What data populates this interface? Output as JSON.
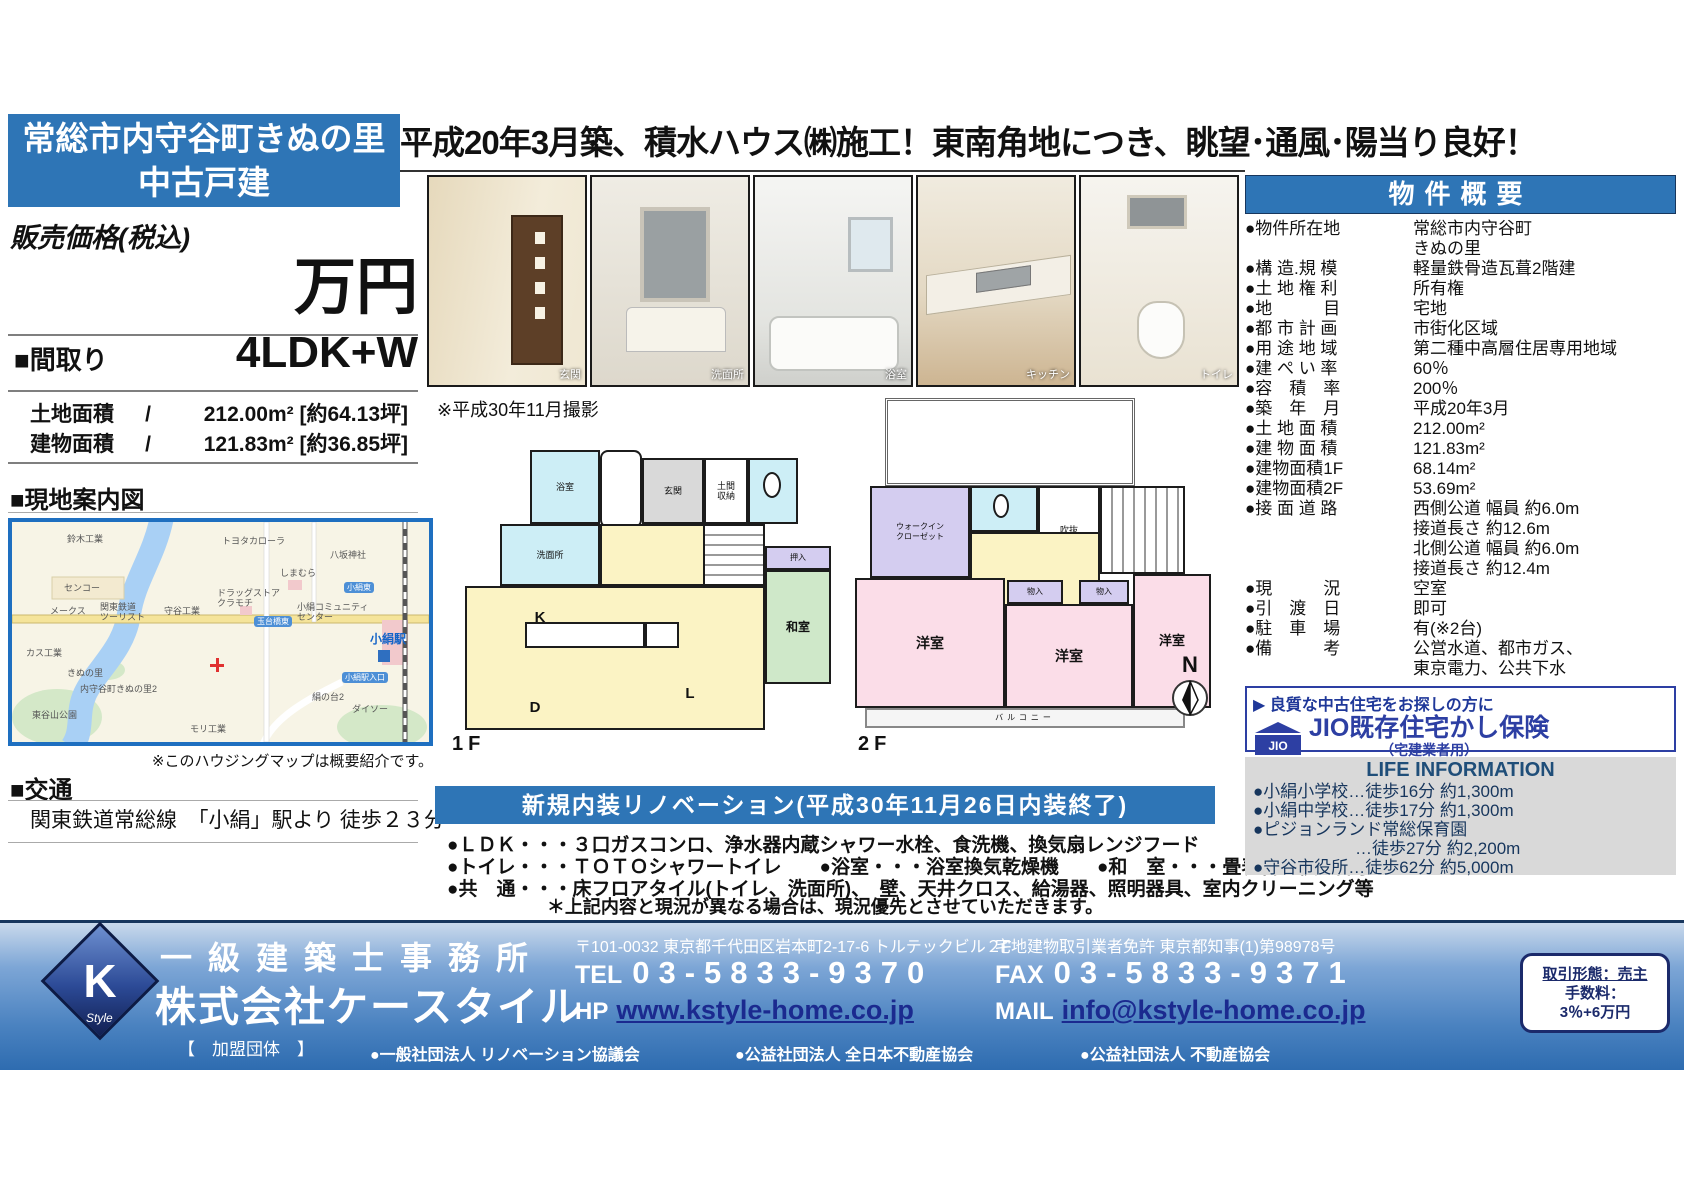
{
  "colors": {
    "accent_blue": "#2e75b6",
    "jio_navy": "#2d3fa3",
    "life_bg": "#d9d9d9"
  },
  "left": {
    "title_line1": "常総市内守谷町きぬの里",
    "title_line2": "中古戸建",
    "price_label": "販売価格(税込)",
    "price_unit": "万円",
    "madori_label": "■間取り",
    "madori_value": "4LDK+W",
    "land_label": "土地面積",
    "land_sep": "/",
    "land_value": "212.00m² [約64.13坪]",
    "bldg_label": "建物面積",
    "bldg_sep": "/",
    "bldg_value": "121.83m² [約36.85坪]",
    "map_heading": "■現地案内図",
    "map_note": "※このハウジングマップは概要紹介です。",
    "access_heading": "■交通",
    "access_text": "関東鉄道常総線　「小絹」駅より 徒歩２３分"
  },
  "headline": "平成20年3月築、積水ハウス㈱施工！東南角地につき、眺望･通風･陽当り良好！",
  "photos": [
    {
      "caption": "玄関"
    },
    {
      "caption": "洗面所"
    },
    {
      "caption": "浴室"
    },
    {
      "caption": "キッチン"
    },
    {
      "caption": "トイレ"
    }
  ],
  "photo_note": "※平成30年11月撮影",
  "map": {
    "labels": [
      "鈴木工業",
      "トヨタカローラ",
      "八坂神社",
      "センコー",
      "しまむら",
      "メークス",
      "関東鉄道\nツーリスト",
      "守谷工業",
      "ドラッグストア\nクラモチ",
      "小絹コミュニティ\nセンター",
      "きぬの里",
      "内守谷町きぬの里2",
      "東谷山公園",
      "モリ工業",
      "絹の台2",
      "カス工業",
      "ダイソー",
      "小絹駅"
    ],
    "chips": [
      "玉台橋東",
      "小絹東",
      "小絹駅入口"
    ]
  },
  "floorplan": {
    "f1_label": "1F",
    "f2_label": "2F",
    "compass": "N",
    "f1_rooms": [
      "浴室",
      "洗面所",
      "玄関",
      "土間\n収納",
      "K",
      "D",
      "L",
      "和室",
      "押入"
    ],
    "f2_rooms": [
      "ウォークイン\nクローゼット",
      "吹抜",
      "洋室",
      "洋室",
      "洋室",
      "物入",
      "物入",
      "バルコニー"
    ]
  },
  "renovation": {
    "banner": "新規内装リノベーション(平成30年11月26日内装終了)",
    "items": [
      "●ＬＤＫ・・・３口ガスコンロ、浄水器内蔵シャワー水栓、食洗機、換気扇レンジフード",
      "●トイレ・・・ＴＯＴＯシャワートイレ　　●浴室・・・浴室換気乾燥機　　●和　室・・・畳表替、襖、障子",
      "●共　通・・・床フロアタイル(トイレ、洗面所)、　壁、天井クロス、給湯器、照明器具、室内クリーニング等"
    ],
    "note": "＊上記内容と現況が異なる場合は、現況優先とさせていただきます。"
  },
  "overview": {
    "heading": "物件概要",
    "rows": [
      {
        "label": "●物件所在地",
        "value": "常総市内守谷町\nきぬの里"
      },
      {
        "label": "●構 造.規 模",
        "value": "軽量鉄骨造瓦葺2階建"
      },
      {
        "label": "●土 地 権 利",
        "value": "所有権"
      },
      {
        "label": "●地　　　目",
        "value": "宅地"
      },
      {
        "label": "●都 市 計 画",
        "value": "市街化区域"
      },
      {
        "label": "●用 途 地 域",
        "value": "第二種中高層住居専用地域"
      },
      {
        "label": "●建 ぺ い 率",
        "value": "60％"
      },
      {
        "label": "●容　積　率",
        "value": "200％"
      },
      {
        "label": "●築　年　月",
        "value": "平成20年3月"
      },
      {
        "label": "●土 地 面 積",
        "value": "212.00m²"
      },
      {
        "label": "●建 物 面 積",
        "value": "121.83m²"
      },
      {
        "label": "●建物面積1F",
        "value": "68.14m²"
      },
      {
        "label": "●建物面積2F",
        "value": "53.69m²"
      },
      {
        "label": "●接 面 道 路",
        "value": "西側公道 幅員 約6.0m\n接道長さ 約12.6m\n北側公道 幅員 約6.0m\n接道長さ 約12.4m"
      },
      {
        "label": "●現　　　況",
        "value": "空室"
      },
      {
        "label": "●引　渡　日",
        "value": "即可"
      },
      {
        "label": "●駐　車　場",
        "value": "有(※2台)"
      },
      {
        "label": "●備　　　考",
        "value": "公営水道、都市ガス、\n東京電力、公共下水"
      }
    ]
  },
  "jio": {
    "catch": "▶ 良質な中古住宅をお探しの方に",
    "logo_text": "JIO",
    "title": "JIO既存住宅かし保険",
    "subtitle": "（宅建業者用）"
  },
  "life": {
    "heading": "LIFE INFORMATION",
    "items": [
      "●小絹小学校…徒歩16分 約1,300m",
      "●小絹中学校…徒歩17分 約1,300m",
      "●ピジョンランド常総保育園\n　　　　　　…徒歩27分 約2,200m",
      "●守谷市役所…徒歩62分 約5,000m"
    ]
  },
  "footer": {
    "logo_k": "K",
    "logo_style": "Style",
    "office_type": "一級建築士事務所",
    "company": "株式会社ケースタイル",
    "member": "【　加盟団体　】",
    "postal_address": "〒101-0032 東京都千代田区岩本町2-17-6 トルテックビル２F",
    "license": "宅地建物取引業者免許 東京都知事(1)第98978号",
    "tel_label": "TEL",
    "tel": "03-5833-9370",
    "fax_label": "FAX",
    "fax": "03-5833-9371",
    "hp_label": "HP",
    "hp": "www.kstyle-home.co.jp",
    "mail_label": "MAIL",
    "mail": "info@kstyle-home.co.jp",
    "associations": [
      "●一般社団法人 リノベーション協議会",
      "●公益社団法人 全日本不動産協会",
      "●公益社団法人 不動産協会"
    ],
    "deal_line1": "取引形態：売主",
    "deal_line2": "手数料：",
    "deal_line3": "3％+6万円"
  }
}
